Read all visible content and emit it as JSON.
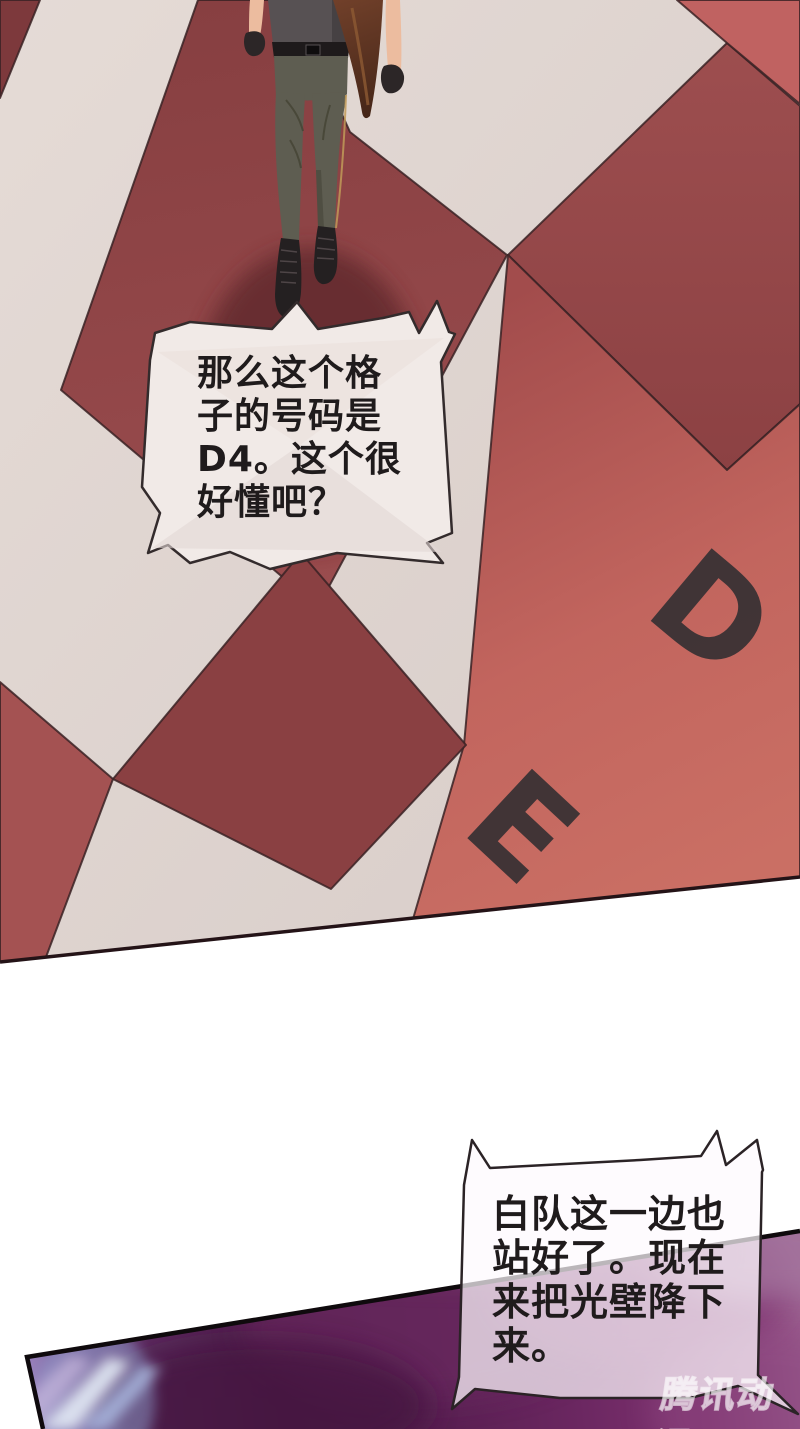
{
  "page": {
    "width": 800,
    "height": 1429,
    "background_color": "#ffffff"
  },
  "top_panel": {
    "type": "checkerboard-floor-scene",
    "floor_letters": {
      "d": "D",
      "e": "E"
    },
    "speech_bubble": {
      "text": "那么这个格\n子的号码是\nD4。这个很\n好懂吧？"
    },
    "colors": {
      "tile_cream": "#e0d5d0",
      "tile_salmon": "#c66c63",
      "tile_maroon": "#8c4143",
      "tile_maroon_light": "#9c4c4d",
      "tile_outline": "#3a2224",
      "floor_letter": "#3a3234",
      "bubble_fill": "#f1eae7",
      "panel_edge": "#241317",
      "shadow": "#63292e"
    }
  },
  "bottom_panel": {
    "type": "light-wall-scene",
    "speech_bubble": {
      "text": "白队这一边也\n站好了。现在\n来把光壁降下\n来。"
    },
    "watermark": "腾讯动漫",
    "colors": {
      "purple_dark": "#4c1b47",
      "purple_mid": "#6f2863",
      "purple_light": "#9a5e8e",
      "streak_blue": "#aebde4",
      "streak_white": "#e3eaf5",
      "border": "#0f0a0d",
      "bubble_tint": "rgba(253,250,253,0.72)"
    }
  }
}
